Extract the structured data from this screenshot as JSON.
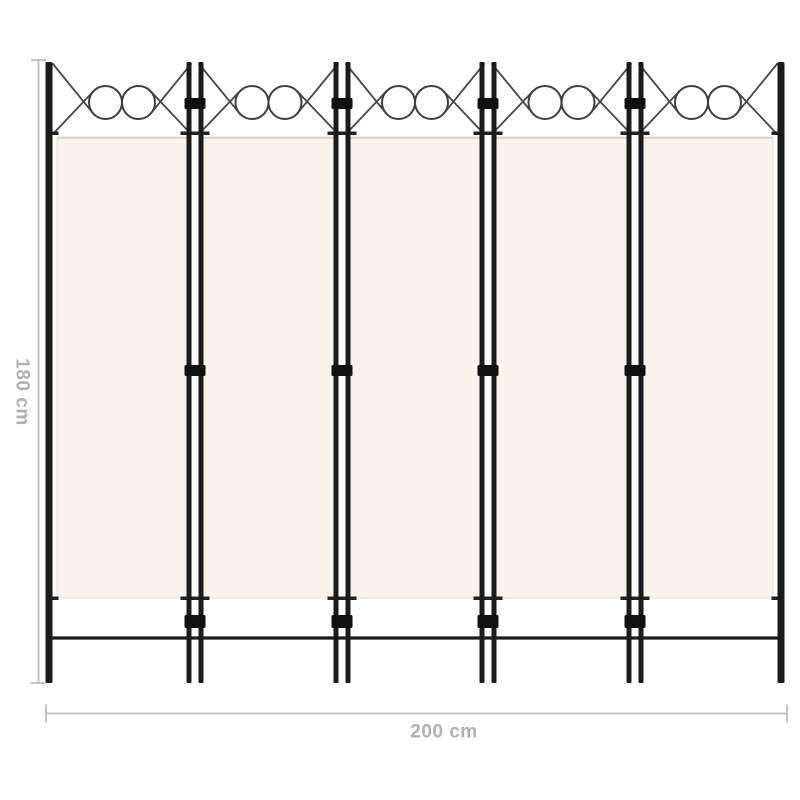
{
  "figure": {
    "subject": "5-panel folding room divider, black metal frame with cream fabric panels and decorative circle wirework tops",
    "panel_count": 5
  },
  "dimensions": {
    "height_label": "180 cm",
    "width_label": "200 cm"
  },
  "colors": {
    "background": "#ffffff",
    "frame": "#1b1b1b",
    "wire": "#474747",
    "fabric": "#f9f3ec",
    "fabric_seam": "#ddd7cb",
    "dimension_line": "#c4c4c4",
    "dimension_text": "#b1b1b1"
  }
}
